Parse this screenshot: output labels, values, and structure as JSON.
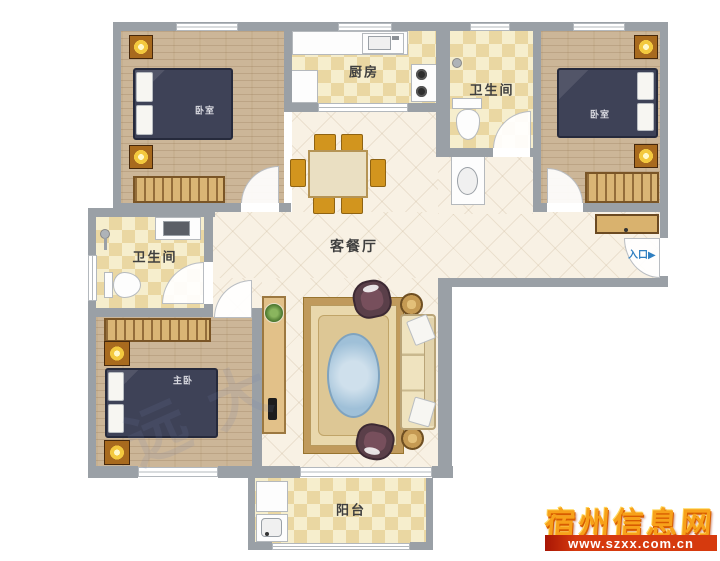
{
  "plan": {
    "rooms": {
      "bedroom_left": {
        "label": "卧室"
      },
      "bedroom_right": {
        "label": "卧室"
      },
      "master_bedroom": {
        "label": "主卧"
      },
      "kitchen": {
        "label": "厨房"
      },
      "bathroom_top": {
        "label": "卫生间"
      },
      "bathroom_left": {
        "label": "卫生间"
      },
      "living_dining": {
        "label": "客餐厅"
      },
      "balcony": {
        "label": "阳台"
      }
    },
    "entrance": {
      "label": "入口",
      "arrow": "▶"
    },
    "faint_watermark_text": "远大"
  },
  "watermark": {
    "title": "宿州信息网",
    "url": "www.szxx.com.cn"
  },
  "colors": {
    "wall": "#9aa0a6",
    "wood_floor": "#ccb698",
    "tile_floor": "#f6eecd",
    "tile_check": "#ead7a2",
    "living_floor": "#f8f1e4",
    "bed": "#3e4257",
    "dining_orange": "#d2951e",
    "watermark_orange": "#f7a11a",
    "watermark_red": "#d63a0e",
    "entrance_blue": "#2f7fc1"
  }
}
